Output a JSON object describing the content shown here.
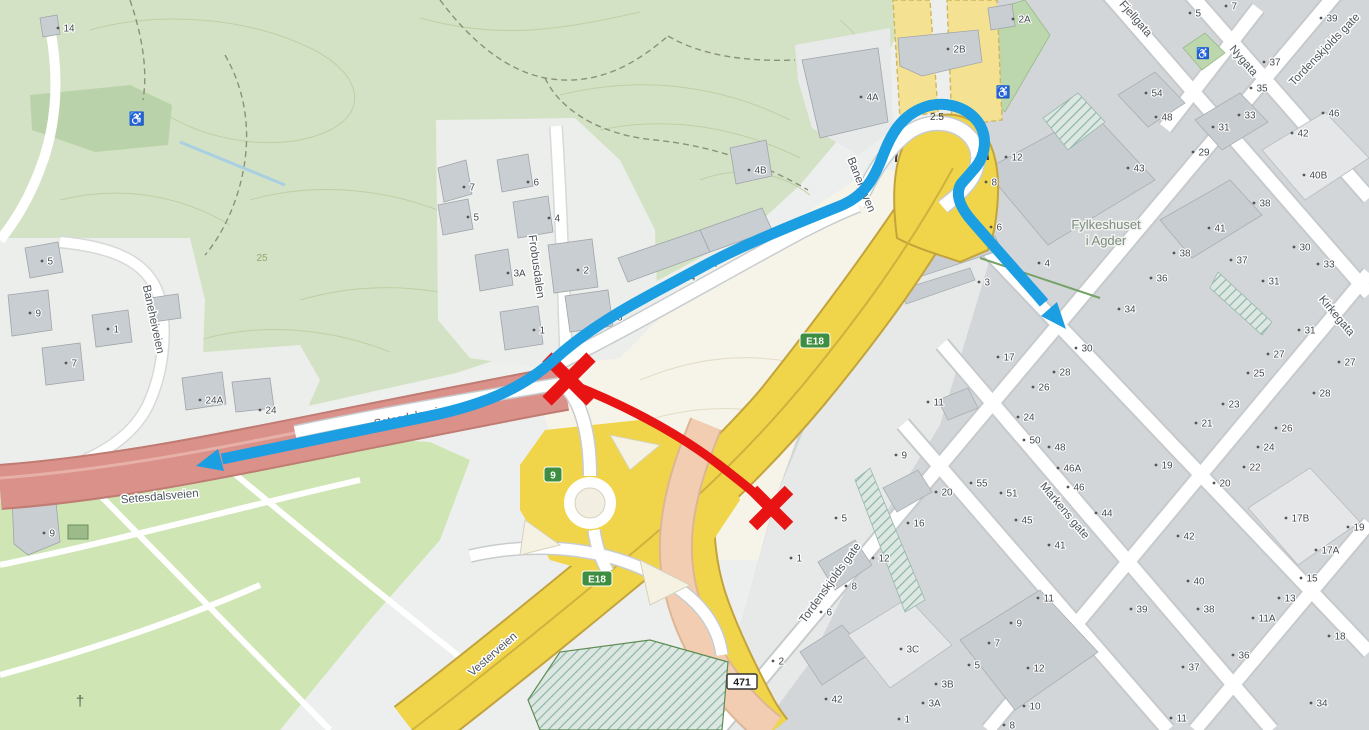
{
  "map": {
    "overlay_colors": {
      "route_blue": "#1b9ee2",
      "closure_red": "#e81414"
    },
    "street_labels": [
      {
        "text": "Baneheiveien",
        "x": 150,
        "y": 320,
        "rotate": 78,
        "size": 11.5
      },
      {
        "text": "Frobusdalen",
        "x": 533,
        "y": 267,
        "rotate": 82,
        "size": 11.5
      },
      {
        "text": "Setesdalsveien",
        "x": 160,
        "y": 500,
        "rotate": -5,
        "size": 11.5
      },
      {
        "text": "Setesdalsveien",
        "x": 413,
        "y": 420,
        "rotate": -11,
        "size": 11.5
      },
      {
        "text": "Vesterveien",
        "x": 495,
        "y": 657,
        "rotate": -41,
        "size": 12.5
      },
      {
        "text": "Banehaven",
        "x": 858,
        "y": 186,
        "rotate": 68,
        "size": 11.5
      },
      {
        "text": "Fjellgata",
        "x": 1133,
        "y": 21,
        "rotate": 49,
        "size": 11.5
      },
      {
        "text": "Nygata",
        "x": 1241,
        "y": 63,
        "rotate": 49,
        "size": 11.5
      },
      {
        "text": "Tordenskjolds gate",
        "x": 1327,
        "y": 52,
        "rotate": -46,
        "size": 11.5
      },
      {
        "text": "Tordenskjolds gate",
        "x": 833,
        "y": 585,
        "rotate": -54,
        "size": 12.5
      },
      {
        "text": "Markens gate",
        "x": 1062,
        "y": 513,
        "rotate": 50,
        "size": 12.5
      },
      {
        "text": "Kirkegata",
        "x": 1334,
        "y": 318,
        "rotate": 50,
        "size": 11.5
      }
    ],
    "area_labels": [
      {
        "text": "Fylkeshuset",
        "x": 1106,
        "y": 229,
        "cls": "area-label"
      },
      {
        "text": "i Agder",
        "x": 1106,
        "y": 245,
        "cls": "area-label"
      },
      {
        "text": "25",
        "x": 262,
        "y": 261,
        "cls": "contour-label"
      },
      {
        "text": "2.5",
        "x": 937,
        "y": 120,
        "cls": "clearance-label"
      }
    ],
    "route_badges": [
      {
        "text": "E18",
        "x": 815,
        "y": 341,
        "style": "green"
      },
      {
        "text": "E18",
        "x": 597,
        "y": 579,
        "style": "green"
      },
      {
        "text": "9",
        "x": 553,
        "y": 475,
        "style": "green"
      },
      {
        "text": "471",
        "x": 742,
        "y": 682,
        "style": "white"
      }
    ],
    "icons": [
      {
        "name": "wheelchair-icon",
        "glyph": "♿",
        "x": 137,
        "y": 123,
        "size": 13,
        "color": "#2e5f33"
      },
      {
        "name": "wheelchair-icon",
        "glyph": "♿",
        "x": 1003,
        "y": 96,
        "size": 12,
        "color": "#2e5f33"
      },
      {
        "name": "wheelchair-icon",
        "glyph": "♿",
        "x": 1203,
        "y": 57,
        "size": 11,
        "color": "#2e5f33"
      },
      {
        "name": "cross-icon",
        "glyph": "†",
        "x": 80,
        "y": 706,
        "size": 15,
        "color": "#4d6b4d"
      }
    ],
    "house_numbers": [
      [
        "14",
        58,
        28
      ],
      [
        "5",
        42,
        261
      ],
      [
        "9",
        30,
        313
      ],
      [
        "1",
        108,
        329
      ],
      [
        "7",
        66,
        363
      ],
      [
        "24A",
        200,
        400
      ],
      [
        "24",
        260,
        410
      ],
      [
        "9",
        44,
        533
      ],
      [
        "7",
        464,
        187
      ],
      [
        "6",
        528,
        182
      ],
      [
        "5",
        468,
        217
      ],
      [
        "4",
        549,
        218
      ],
      [
        "3A",
        508,
        273
      ],
      [
        "2",
        578,
        270
      ],
      [
        "1",
        534,
        330
      ],
      [
        "18",
        606,
        317
      ],
      [
        "14",
        679,
        277
      ],
      [
        "12",
        701,
        263
      ],
      [
        "8",
        733,
        247
      ],
      [
        "4B",
        749,
        170
      ],
      [
        "4A",
        861,
        97
      ],
      [
        "2B",
        948,
        49
      ],
      [
        "2A",
        1013,
        19
      ],
      [
        "5",
        1190,
        13
      ],
      [
        "7",
        1226,
        6
      ],
      [
        "39",
        1321,
        18
      ],
      [
        "54",
        1146,
        93
      ],
      [
        "48",
        1156,
        117
      ],
      [
        "37",
        1264,
        62
      ],
      [
        "35",
        1251,
        88
      ],
      [
        "33",
        1239,
        115
      ],
      [
        "31",
        1213,
        127
      ],
      [
        "29",
        1193,
        152
      ],
      [
        "46",
        1323,
        113
      ],
      [
        "42",
        1292,
        133
      ],
      [
        "40B",
        1304,
        175
      ],
      [
        "12",
        1006,
        157
      ],
      [
        "8",
        986,
        182
      ],
      [
        "6",
        991,
        227
      ],
      [
        "4",
        1039,
        263
      ],
      [
        "3",
        979,
        282
      ],
      [
        "43",
        1128,
        168
      ],
      [
        "38",
        1254,
        203
      ],
      [
        "41",
        1209,
        228
      ],
      [
        "38",
        1174,
        253
      ],
      [
        "36",
        1151,
        278
      ],
      [
        "34",
        1119,
        309
      ],
      [
        "30",
        1294,
        247
      ],
      [
        "33",
        1318,
        264
      ],
      [
        "37",
        1231,
        260
      ],
      [
        "31",
        1263,
        281
      ],
      [
        "31",
        1299,
        330
      ],
      [
        "27",
        1268,
        354
      ],
      [
        "25",
        1248,
        373
      ],
      [
        "27",
        1339,
        362
      ],
      [
        "28",
        1314,
        393
      ],
      [
        "23",
        1223,
        404
      ],
      [
        "17",
        998,
        357
      ],
      [
        "11",
        928,
        402
      ],
      [
        "30",
        1076,
        348
      ],
      [
        "28",
        1054,
        372
      ],
      [
        "26",
        1033,
        387
      ],
      [
        "24",
        1018,
        417
      ],
      [
        "50",
        1024,
        440
      ],
      [
        "48",
        1049,
        447
      ],
      [
        "46A",
        1058,
        468
      ],
      [
        "46",
        1068,
        487
      ],
      [
        "44",
        1096,
        513
      ],
      [
        "19",
        1156,
        465
      ],
      [
        "21",
        1196,
        423
      ],
      [
        "26",
        1276,
        428
      ],
      [
        "24",
        1258,
        447
      ],
      [
        "22",
        1244,
        467
      ],
      [
        "20",
        1214,
        483
      ],
      [
        "42",
        1178,
        536
      ],
      [
        "17B",
        1286,
        518
      ],
      [
        "19",
        1348,
        527
      ],
      [
        "17A",
        1316,
        550
      ],
      [
        "15",
        1301,
        578
      ],
      [
        "13",
        1279,
        598
      ],
      [
        "11A",
        1253,
        618
      ],
      [
        "40",
        1188,
        581
      ],
      [
        "38",
        1198,
        609
      ],
      [
        "39",
        1131,
        609
      ],
      [
        "36",
        1233,
        655
      ],
      [
        "37",
        1183,
        667
      ],
      [
        "18",
        1329,
        636
      ],
      [
        "34",
        1311,
        703
      ],
      [
        "11",
        1171,
        718
      ],
      [
        "9",
        896,
        455
      ],
      [
        "20",
        936,
        492
      ],
      [
        "55",
        971,
        483
      ],
      [
        "51",
        1001,
        493
      ],
      [
        "45",
        1016,
        520
      ],
      [
        "41",
        1049,
        545
      ],
      [
        "5",
        836,
        518
      ],
      [
        "16",
        908,
        523
      ],
      [
        "1",
        791,
        558
      ],
      [
        "12",
        873,
        558
      ],
      [
        "8",
        846,
        586
      ],
      [
        "6",
        821,
        612
      ],
      [
        "11",
        1038,
        598
      ],
      [
        "9",
        1011,
        623
      ],
      [
        "7",
        989,
        643
      ],
      [
        "5",
        969,
        665
      ],
      [
        "3C",
        901,
        649
      ],
      [
        "3B",
        936,
        684
      ],
      [
        "3A",
        923,
        703
      ],
      [
        "1",
        899,
        719
      ],
      [
        "42",
        826,
        699
      ],
      [
        "12",
        1028,
        668
      ],
      [
        "10",
        1024,
        706
      ],
      [
        "8",
        1004,
        725
      ],
      [
        "2",
        773,
        661
      ]
    ]
  }
}
